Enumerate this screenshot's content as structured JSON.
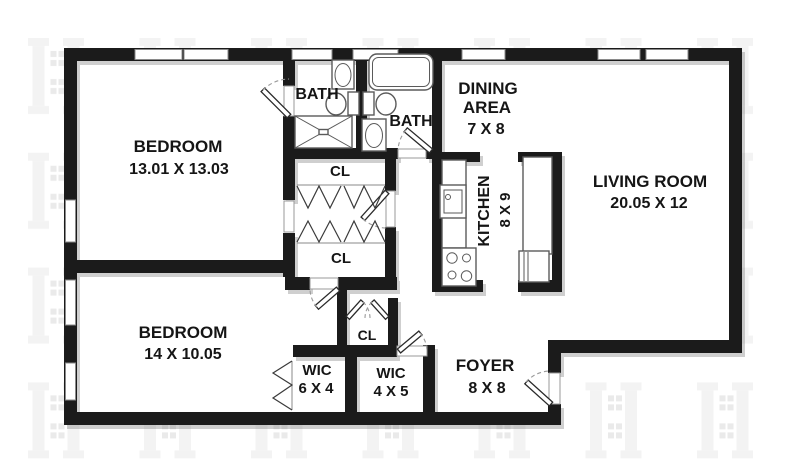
{
  "rooms": {
    "bedroom1": {
      "name": "BEDROOM",
      "dims": "13.01 X 13.03"
    },
    "bedroom2": {
      "name": "BEDROOM",
      "dims": "14 X 10.05"
    },
    "bath1": {
      "name": "BATH"
    },
    "bath2": {
      "name": "BATH"
    },
    "dining": {
      "name_line1": "DINING",
      "name_line2": "AREA",
      "dims": "7 X 8"
    },
    "living": {
      "name": "LIVING ROOM",
      "dims": "20.05 X 12"
    },
    "kitchen": {
      "name": "KITCHEN",
      "dims": "8 X 9"
    },
    "closet_upper": {
      "name": "CL"
    },
    "closet_lower": {
      "name": "CL"
    },
    "closet_small": {
      "name": "CL"
    },
    "wic_left": {
      "name": "WIC",
      "dims": "6 X 4"
    },
    "wic_right": {
      "name": "WIC",
      "dims": "4 X 5"
    },
    "foyer": {
      "name": "FOYER",
      "dims": "8 X 8"
    }
  },
  "colors": {
    "wall": "#1b1b1b",
    "label_text": "#151515",
    "fixture_outline": "#5a5a5a",
    "window_outline": "#8a8a8a",
    "watermark": "#f3f3f3",
    "background": "#ffffff"
  }
}
